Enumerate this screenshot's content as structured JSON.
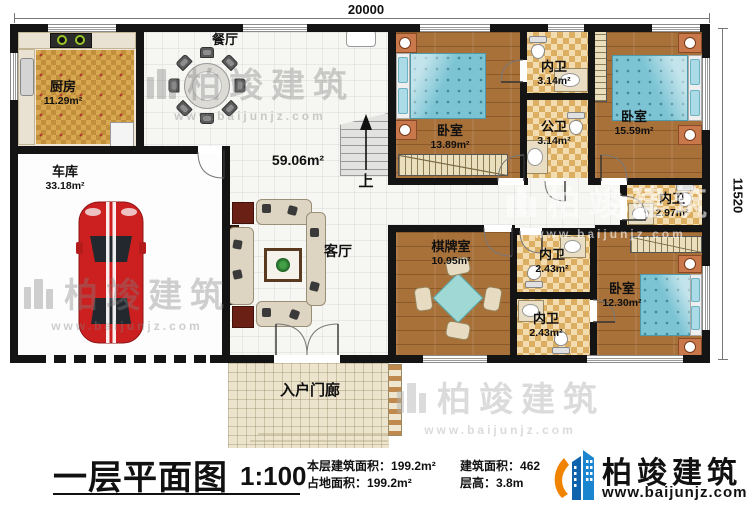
{
  "meta": {
    "plan_title": "一层平面图",
    "scale": "1:100"
  },
  "dimensions": {
    "top": "20000",
    "right": "11520"
  },
  "stairs": {
    "up_label": "上"
  },
  "rooms": {
    "kitchen": {
      "name": "厨房",
      "area": "11.29m²"
    },
    "dining": {
      "name": "餐厅"
    },
    "garage": {
      "name": "车库",
      "area": "33.18m²"
    },
    "living": {
      "name": "客厅",
      "area": "59.06m²"
    },
    "bedroom_a": {
      "name": "卧室",
      "area": "13.89m²"
    },
    "bath_inner_a": {
      "name": "内卫",
      "area": "3.14m²"
    },
    "bath_public": {
      "name": "公卫",
      "area": "3.14m²"
    },
    "bedroom_b": {
      "name": "卧室",
      "area": "15.59m²"
    },
    "bath_inner_b": {
      "name": "内卫",
      "area": "2.97m²"
    },
    "game_room": {
      "name": "棋牌室",
      "area": "10.95m²"
    },
    "bath_inner_c": {
      "name": "内卫",
      "area": "2.43m²"
    },
    "bath_inner_d": {
      "name": "内卫",
      "area": "2.43m²"
    },
    "bedroom_c": {
      "name": "卧室",
      "area": "12.30m²"
    },
    "porch": {
      "name": "入户门廊"
    }
  },
  "info": {
    "floor_area_label": "本层建筑面积：",
    "floor_area_value": "199.2m²",
    "land_area_label": "占地面积：",
    "land_area_value": "199.2m²",
    "build_area_label": "建筑面积：",
    "build_area_value": "462",
    "height_label": "层高：",
    "height_value": "3.8m"
  },
  "branding": {
    "watermark_brand": "柏竣建筑",
    "watermark_url": "www.baijunjz.com",
    "logo_brand": "柏竣建筑",
    "logo_url": "www.baijunjz.com"
  },
  "colors": {
    "accent_blue": "#1467b3",
    "accent_orange": "#f08300",
    "wall": "#141414"
  }
}
